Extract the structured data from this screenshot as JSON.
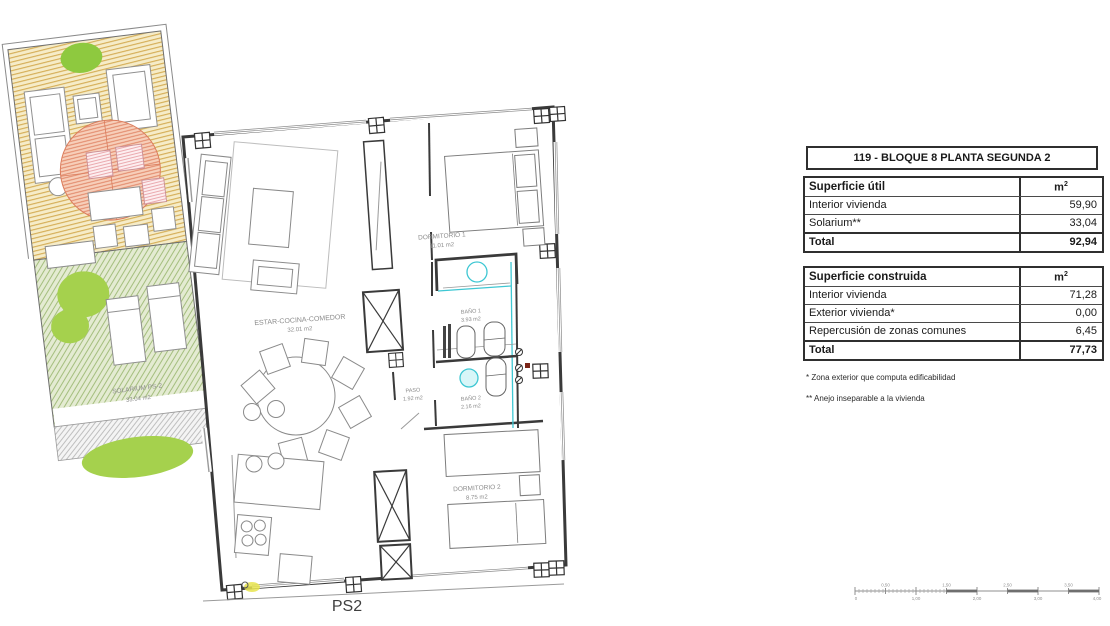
{
  "plan": {
    "sheet_label": "PS2",
    "rooms": {
      "estar": {
        "name": "ESTAR-COCINA-COMEDOR",
        "area": "32.01 m2"
      },
      "dormitorio1": {
        "name": "DORMITORIO 1",
        "area": "11.01 m2"
      },
      "bano1": {
        "name": "BAÑO 1",
        "area": "3.93 m2"
      },
      "paso": {
        "name": "PASO",
        "area": "1.92 m2"
      },
      "bano2": {
        "name": "BAÑO 2",
        "area": "2.16 m2"
      },
      "dormitorio2": {
        "name": "DORMITORIO 2",
        "area": "8.75 m2"
      },
      "solarium": {
        "name": "SOLARIUM PS-2",
        "area": "33.04 m2"
      }
    },
    "colors": {
      "wall": "#3a3a3a",
      "terrace_bg": "#f6ecc8",
      "terrace_hatch": "#d4ab52",
      "solarium_bg": "#e4ebd2",
      "solarium_hatch": "#a3bd7c",
      "parasol": "#e08566",
      "tree_green": "#9bcd43",
      "plumbing_cyan": "#3ec7d3"
    }
  },
  "summary": {
    "title": "119 - BLOQUE 8 PLANTA SEGUNDA 2",
    "useful": {
      "header": "Superficie útil",
      "unit": "m",
      "unit_sup": "2",
      "rows": [
        [
          "Interior vivienda",
          "59,90"
        ],
        [
          "Solarium**",
          "33,04"
        ]
      ],
      "total_label": "Total",
      "total_value": "92,94"
    },
    "built": {
      "header": "Superficie construida",
      "unit": "m",
      "unit_sup": "2",
      "rows": [
        [
          "Interior vivienda",
          "71,28"
        ],
        [
          "Exterior vivienda*",
          "0,00"
        ],
        [
          "Repercusión de zonas comunes",
          "6,45"
        ]
      ],
      "total_label": "Total",
      "total_value": "77,73"
    },
    "footnotes": [
      "* Zona exterior que computa edificabilidad",
      "** Anejo inseparable a la vivienda"
    ]
  },
  "scalebar": {
    "top": [
      "0,50",
      "1,50",
      "2,50",
      "3,50"
    ],
    "bottom": [
      "0",
      "1,00",
      "2,00",
      "3,00",
      "4,00"
    ]
  }
}
